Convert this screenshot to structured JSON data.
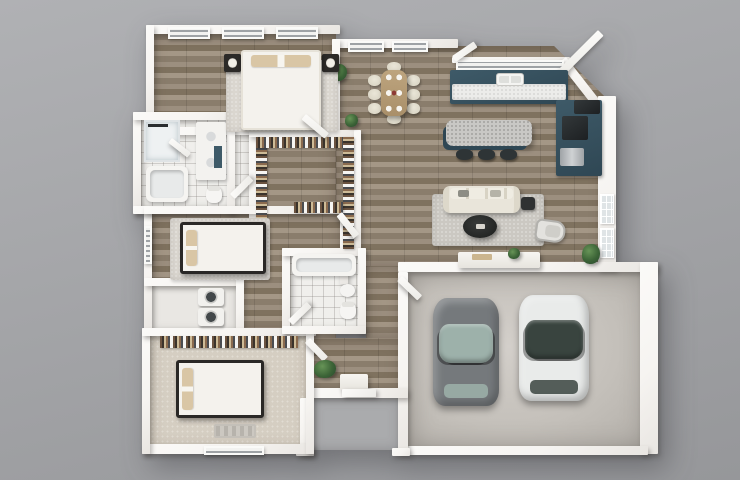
{
  "canvas": {
    "width": 740,
    "height": 480
  },
  "palette": {
    "bg1": "#b0b1b4",
    "bg2": "#96979a",
    "wall": "#f6f4f1",
    "wood1": "#9c8f7f",
    "wood2": "#8a7d6c",
    "wood3": "#a49786",
    "wood4": "#7f725f",
    "tile": "#f0efec",
    "carpet": "#d5cec2",
    "concrete1": "#d3cfca",
    "concrete2": "#b2aea8",
    "teal": "#3e5a68",
    "tealDark": "#2f4754",
    "counter": "#ececea",
    "cream": "#e9e5da",
    "tan": "#d9c6a5",
    "darkwood": "#2a2826",
    "rug": "#cbc8c2",
    "rugLight": "#dad6cf",
    "green1": "#679457",
    "green2": "#2f5130",
    "carGray": "#75797c",
    "carGrayGlass": "#9db1aa",
    "carWhite": "#e9ebea",
    "carWhiteGlass": "#39443f"
  },
  "scene": {
    "elements": [
      {
        "n": "floor-master-bedroom",
        "cls": "floor-wood",
        "x": 152,
        "y": 33,
        "w": 184,
        "h": 100
      },
      {
        "n": "floor-great-room",
        "cls": "floor-wood cut-tr",
        "x": 336,
        "y": 46,
        "w": 270,
        "h": 220
      },
      {
        "n": "floor-hallway",
        "cls": "floor-wood",
        "x": 233,
        "y": 133,
        "w": 103,
        "h": 205
      },
      {
        "n": "floor-hall-corridor",
        "cls": "floor-wood",
        "x": 366,
        "y": 266,
        "w": 36,
        "h": 72
      },
      {
        "n": "floor-entry",
        "cls": "floor-wood",
        "x": 310,
        "y": 338,
        "w": 92,
        "h": 56
      },
      {
        "n": "floor-master-bath",
        "cls": "floor-tile",
        "x": 141,
        "y": 118,
        "w": 108,
        "h": 90
      },
      {
        "n": "floor-bedroom2",
        "cls": "floor-wood",
        "x": 152,
        "y": 212,
        "w": 190,
        "h": 120
      },
      {
        "n": "floor-laundry-closet",
        "cls": "floor-plain",
        "x": 152,
        "y": 286,
        "w": 84,
        "h": 44
      },
      {
        "n": "floor-bath2",
        "cls": "floor-tile",
        "x": 290,
        "y": 252,
        "w": 72,
        "h": 78
      },
      {
        "n": "floor-bedroom3",
        "cls": "floor-carpet",
        "x": 150,
        "y": 334,
        "w": 158,
        "h": 114
      },
      {
        "n": "floor-garage",
        "cls": "floor-concrete",
        "x": 408,
        "y": 272,
        "w": 240,
        "h": 178
      },
      {
        "n": "floor-porch",
        "cls": "floor-porch",
        "x": 312,
        "y": 398,
        "w": 88,
        "h": 52
      },
      {
        "n": "wall-master-top",
        "cls": "wall",
        "x": 146,
        "y": 25,
        "w": 194,
        "h": 9
      },
      {
        "n": "wall-master-left",
        "cls": "wall",
        "x": 146,
        "y": 25,
        "w": 8,
        "h": 95
      },
      {
        "n": "wall-dining-top",
        "cls": "wall",
        "x": 332,
        "y": 39,
        "w": 126,
        "h": 9
      },
      {
        "n": "wall-kitchen-top",
        "cls": "wall",
        "x": 452,
        "y": 57,
        "w": 118,
        "h": 6
      },
      {
        "n": "wall-corner-diagonal",
        "cls": "wall",
        "x": 566,
        "y": 57,
        "w": 54,
        "h": 9,
        "rot": 52
      },
      {
        "n": "wall-right-living",
        "cls": "wall",
        "x": 598,
        "y": 96,
        "w": 18,
        "h": 174
      },
      {
        "n": "wall-garage-top",
        "cls": "wall",
        "x": 398,
        "y": 262,
        "w": 260,
        "h": 10
      },
      {
        "n": "wall-garage-right",
        "cls": "wall",
        "x": 640,
        "y": 262,
        "w": 18,
        "h": 192
      },
      {
        "n": "wall-garage-bottom",
        "cls": "wall",
        "x": 408,
        "y": 446,
        "w": 240,
        "h": 9
      },
      {
        "n": "wall-garage-left",
        "cls": "wall",
        "x": 398,
        "y": 272,
        "w": 10,
        "h": 182
      },
      {
        "n": "wall-entry-bottom",
        "cls": "wall",
        "x": 306,
        "y": 388,
        "w": 102,
        "h": 10
      },
      {
        "n": "wall-porch-left",
        "cls": "wall",
        "x": 300,
        "y": 398,
        "w": 10,
        "h": 56
      },
      {
        "n": "wall-porch-left-foot",
        "cls": "wall",
        "x": 296,
        "y": 448,
        "w": 18,
        "h": 8
      },
      {
        "n": "wall-porch-right-foot",
        "cls": "wall",
        "x": 392,
        "y": 448,
        "w": 18,
        "h": 8
      },
      {
        "n": "wall-bedroom3-bottom",
        "cls": "wall",
        "x": 142,
        "y": 444,
        "w": 172,
        "h": 10
      },
      {
        "n": "wall-bedroom3-left",
        "cls": "wall",
        "x": 142,
        "y": 328,
        "w": 8,
        "h": 126
      },
      {
        "n": "wall-bedroom2-left",
        "cls": "wall",
        "x": 144,
        "y": 206,
        "w": 8,
        "h": 126
      },
      {
        "n": "wall-masterbath-left",
        "cls": "wall",
        "x": 133,
        "y": 112,
        "w": 8,
        "h": 102
      },
      {
        "n": "wall-masterbath-top",
        "cls": "wall",
        "x": 133,
        "y": 112,
        "w": 120,
        "h": 8
      },
      {
        "n": "wall-masterbath-bottom",
        "cls": "wall",
        "x": 133,
        "y": 206,
        "w": 120,
        "h": 8
      },
      {
        "n": "wall-master-bottom",
        "cls": "wall",
        "x": 152,
        "y": 127,
        "w": 188,
        "h": 8
      },
      {
        "n": "wall-master-dining",
        "cls": "wall",
        "x": 332,
        "y": 39,
        "w": 8,
        "h": 96
      },
      {
        "n": "wall-bath-closet",
        "cls": "wall",
        "x": 227,
        "y": 112,
        "w": 8,
        "h": 102
      },
      {
        "n": "wall-closet-left",
        "cls": "wall",
        "x": 249,
        "y": 130,
        "w": 7,
        "h": 122
      },
      {
        "n": "wall-closet-top",
        "cls": "wall",
        "x": 249,
        "y": 130,
        "w": 112,
        "h": 7
      },
      {
        "n": "wall-closet-right",
        "cls": "wall",
        "x": 354,
        "y": 130,
        "w": 7,
        "h": 122
      },
      {
        "n": "wall-bedroom2-top",
        "cls": "wall",
        "x": 144,
        "y": 206,
        "w": 204,
        "h": 8
      },
      {
        "n": "wall-bedroom2-right",
        "cls": "wall",
        "x": 340,
        "y": 206,
        "w": 8,
        "h": 78
      },
      {
        "n": "wall-laundry-top",
        "cls": "wall",
        "x": 144,
        "y": 278,
        "w": 100,
        "h": 8
      },
      {
        "n": "wall-laundry-right",
        "cls": "wall",
        "x": 236,
        "y": 278,
        "w": 8,
        "h": 58
      },
      {
        "n": "wall-bedroom3-top",
        "cls": "wall",
        "x": 142,
        "y": 328,
        "w": 174,
        "h": 8
      },
      {
        "n": "wall-entry-left",
        "cls": "wall",
        "x": 306,
        "y": 328,
        "w": 8,
        "h": 126
      },
      {
        "n": "wall-bath2-left",
        "cls": "wall",
        "x": 282,
        "y": 248,
        "w": 8,
        "h": 86
      },
      {
        "n": "wall-bath2-top",
        "cls": "wall",
        "x": 282,
        "y": 248,
        "w": 84,
        "h": 8
      },
      {
        "n": "wall-bath2-right",
        "cls": "wall",
        "x": 358,
        "y": 248,
        "w": 8,
        "h": 86
      },
      {
        "n": "wall-bath2-bottom",
        "cls": "wall",
        "x": 282,
        "y": 326,
        "w": 84,
        "h": 8
      },
      {
        "n": "window-master-1",
        "cls": "win-louver",
        "x": 168,
        "y": 27,
        "w": 42,
        "h": 12
      },
      {
        "n": "window-master-2",
        "cls": "win-louver",
        "x": 222,
        "y": 27,
        "w": 42,
        "h": 12
      },
      {
        "n": "window-master-3",
        "cls": "win-louver",
        "x": 276,
        "y": 27,
        "w": 42,
        "h": 12
      },
      {
        "n": "window-dining-1",
        "cls": "win-louver",
        "x": 348,
        "y": 41,
        "w": 36,
        "h": 11
      },
      {
        "n": "window-dining-2",
        "cls": "win-louver",
        "x": 392,
        "y": 41,
        "w": 36,
        "h": 11
      },
      {
        "n": "window-kitchen",
        "cls": "win-louver",
        "x": 456,
        "y": 60,
        "w": 108,
        "h": 10
      },
      {
        "n": "window-bedroom2",
        "cls": "win-louver",
        "x": 144,
        "y": 226,
        "w": 8,
        "h": 38
      },
      {
        "n": "window-bedroom3",
        "cls": "win-louver",
        "x": 204,
        "y": 446,
        "w": 60,
        "h": 9
      },
      {
        "n": "window-living-1",
        "cls": "win-grid",
        "x": 600,
        "y": 194,
        "w": 14,
        "h": 30
      },
      {
        "n": "window-living-2",
        "cls": "win-grid",
        "x": 600,
        "y": 228,
        "w": 14,
        "h": 30
      },
      {
        "n": "open-window-pane",
        "cls": "door",
        "x": 452,
        "y": 56,
        "w": 26,
        "h": 7,
        "rot": -34
      },
      {
        "n": "patio-door-open",
        "cls": "door",
        "x": 598,
        "y": 30,
        "w": 8,
        "h": 56,
        "rot": 45
      },
      {
        "n": "kitchen-counter-teal",
        "cls": "cab-teal",
        "x": 450,
        "y": 70,
        "w": 118,
        "h": 34
      },
      {
        "n": "kitchen-counter-top",
        "cls": "counter-white",
        "x": 452,
        "y": 84,
        "w": 114,
        "h": 16
      },
      {
        "n": "kitchen-sink",
        "cls": "sink",
        "x": 496,
        "y": 73,
        "w": 28,
        "h": 13
      },
      {
        "n": "kitchen-cabinets-right",
        "cls": "cab-teal",
        "x": 556,
        "y": 100,
        "w": 46,
        "h": 76
      },
      {
        "n": "refrigerator",
        "cls": "appliance-dark",
        "x": 574,
        "y": 100,
        "w": 26,
        "h": 14
      },
      {
        "n": "stove-cooktop",
        "cls": "appliance-dark",
        "x": 562,
        "y": 116,
        "w": 26,
        "h": 24
      },
      {
        "n": "oven",
        "cls": "appliance-steel",
        "x": 560,
        "y": 148,
        "w": 24,
        "h": 18
      },
      {
        "n": "kitchen-island",
        "cls": "island-top",
        "x": 446,
        "y": 120,
        "w": 86,
        "h": 26
      },
      {
        "n": "island-stool-1",
        "cls": "stool",
        "x": 456,
        "y": 149,
        "w": 17,
        "h": 11
      },
      {
        "n": "island-stool-2",
        "cls": "stool",
        "x": 478,
        "y": 149,
        "w": 17,
        "h": 11
      },
      {
        "n": "island-stool-3",
        "cls": "stool",
        "x": 500,
        "y": 149,
        "w": 17,
        "h": 11
      },
      {
        "n": "dining-chair-head",
        "cls": "chair-cream",
        "x": 387,
        "y": 62,
        "w": 14,
        "h": 10
      },
      {
        "n": "dining-chair-foot",
        "cls": "chair-cream",
        "x": 387,
        "y": 114,
        "w": 14,
        "h": 10
      },
      {
        "n": "dining-chair-1",
        "cls": "chair-cream",
        "x": 368,
        "y": 75,
        "w": 13,
        "h": 11
      },
      {
        "n": "dining-chair-2",
        "cls": "chair-cream",
        "x": 368,
        "y": 89,
        "w": 13,
        "h": 11
      },
      {
        "n": "dining-chair-3",
        "cls": "chair-cream",
        "x": 368,
        "y": 103,
        "w": 13,
        "h": 11
      },
      {
        "n": "dining-chair-4",
        "cls": "chair-cream",
        "x": 407,
        "y": 75,
        "w": 13,
        "h": 11
      },
      {
        "n": "dining-chair-5",
        "cls": "chair-cream",
        "x": 407,
        "y": 89,
        "w": 13,
        "h": 11
      },
      {
        "n": "dining-chair-6",
        "cls": "chair-cream",
        "x": 407,
        "y": 103,
        "w": 13,
        "h": 11
      },
      {
        "n": "dining-table",
        "cls": "table-wood",
        "x": 381,
        "y": 70,
        "w": 26,
        "h": 46
      },
      {
        "n": "plant-dining-wall",
        "cls": "plant",
        "x": 330,
        "y": 64,
        "w": 17,
        "h": 17
      },
      {
        "n": "plant-hall-corner",
        "cls": "plant",
        "x": 345,
        "y": 114,
        "w": 13,
        "h": 13
      },
      {
        "n": "living-rug",
        "cls": "rug",
        "x": 432,
        "y": 194,
        "w": 112,
        "h": 52
      },
      {
        "n": "sofa",
        "cls": "sofa",
        "x": 443,
        "y": 186,
        "w": 77,
        "h": 27
      },
      {
        "n": "coffee-table",
        "cls": "coffee-table",
        "x": 463,
        "y": 215,
        "w": 34,
        "h": 23
      },
      {
        "n": "side-table",
        "cls": "side-table",
        "x": 521,
        "y": 197,
        "w": 14,
        "h": 13
      },
      {
        "n": "accent-chair",
        "cls": "accent-chair",
        "x": 537,
        "y": 218,
        "w": 30,
        "h": 22,
        "rot": 8
      },
      {
        "n": "media-console",
        "cls": "console",
        "x": 458,
        "y": 252,
        "w": 82,
        "h": 16
      },
      {
        "n": "console-decor",
        "cls": "deco-box",
        "x": 472,
        "y": 254,
        "w": 20,
        "h": 6
      },
      {
        "n": "plant-console",
        "cls": "plant",
        "x": 508,
        "y": 248,
        "w": 12,
        "h": 11
      },
      {
        "n": "plant-living-corner",
        "cls": "plant",
        "x": 582,
        "y": 244,
        "w": 18,
        "h": 20
      },
      {
        "n": "shower",
        "cls": "shower",
        "x": 144,
        "y": 120,
        "w": 36,
        "h": 42
      },
      {
        "n": "shower-door",
        "cls": "door",
        "x": 172,
        "y": 138,
        "w": 24,
        "h": 6,
        "rot": 38
      },
      {
        "n": "bath-vanity",
        "cls": "vanity",
        "x": 196,
        "y": 122,
        "w": 30,
        "h": 58
      },
      {
        "n": "vanity-accent",
        "cls": "teal-accent",
        "x": 214,
        "y": 146,
        "w": 8,
        "h": 22
      },
      {
        "n": "bathtub",
        "cls": "tub",
        "x": 146,
        "y": 166,
        "w": 42,
        "h": 36
      },
      {
        "n": "toilet",
        "cls": "toilet",
        "x": 206,
        "y": 186,
        "w": 16,
        "h": 17
      },
      {
        "n": "door-masterbath",
        "cls": "door",
        "x": 230,
        "y": 194,
        "w": 26,
        "h": 7,
        "rot": -45
      },
      {
        "n": "closet-rack-left",
        "cls": "rack-v",
        "x": 256,
        "y": 137,
        "w": 11,
        "h": 112
      },
      {
        "n": "closet-rack-top",
        "cls": "rack-h",
        "x": 256,
        "y": 137,
        "w": 96,
        "h": 11
      },
      {
        "n": "closet-rack-right",
        "cls": "rack-v",
        "x": 343,
        "y": 137,
        "w": 11,
        "h": 112
      },
      {
        "n": "closet-rack-mid",
        "cls": "rack-h",
        "x": 294,
        "y": 202,
        "w": 49,
        "h": 11
      },
      {
        "n": "master-rug",
        "cls": "rug light",
        "x": 226,
        "y": 60,
        "w": 112,
        "h": 72
      },
      {
        "n": "nightstand-left",
        "cls": "nightstand",
        "x": 224,
        "y": 54,
        "w": 17,
        "h": 18
      },
      {
        "n": "nightstand-right",
        "cls": "nightstand",
        "x": 322,
        "y": 54,
        "w": 17,
        "h": 18
      },
      {
        "n": "master-bed",
        "cls": "bed-v light",
        "x": 241,
        "y": 50,
        "w": 80,
        "h": 80
      },
      {
        "n": "door-master",
        "cls": "door",
        "x": 306,
        "y": 114,
        "w": 30,
        "h": 7,
        "rot": 40
      },
      {
        "n": "bedroom2-rug",
        "cls": "rug light",
        "x": 170,
        "y": 218,
        "w": 100,
        "h": 62
      },
      {
        "n": "bedroom2-bed",
        "cls": "bed-h dark",
        "x": 180,
        "y": 222,
        "w": 86,
        "h": 52
      },
      {
        "n": "door-bedroom2",
        "cls": "door",
        "x": 342,
        "y": 212,
        "w": 28,
        "h": 7,
        "rot": 52
      },
      {
        "n": "washer",
        "cls": "washer",
        "x": 198,
        "y": 288,
        "w": 26,
        "h": 18
      },
      {
        "n": "dryer",
        "cls": "washer",
        "x": 198,
        "y": 308,
        "w": 26,
        "h": 18
      },
      {
        "n": "bathtub2",
        "cls": "tub",
        "x": 292,
        "y": 254,
        "w": 64,
        "h": 22
      },
      {
        "n": "sink-pedestal",
        "cls": "sink-ped",
        "x": 340,
        "y": 284,
        "w": 15,
        "h": 13
      },
      {
        "n": "toilet2",
        "cls": "toilet",
        "x": 340,
        "y": 302,
        "w": 16,
        "h": 17
      },
      {
        "n": "door-bath2",
        "cls": "door",
        "x": 288,
        "y": 320,
        "w": 26,
        "h": 7,
        "rot": -44
      },
      {
        "n": "bedroom3-closet-rack",
        "cls": "rack-h",
        "x": 160,
        "y": 336,
        "w": 138,
        "h": 12
      },
      {
        "n": "bedroom3-bed",
        "cls": "bed-h dark",
        "x": 176,
        "y": 360,
        "w": 88,
        "h": 58
      },
      {
        "n": "bedroom3-mat",
        "cls": "mat",
        "x": 214,
        "y": 424,
        "w": 42,
        "h": 14
      },
      {
        "n": "door-bedroom3",
        "cls": "door",
        "x": 310,
        "y": 338,
        "w": 26,
        "h": 7,
        "rot": 46
      },
      {
        "n": "plant-entry",
        "cls": "plant",
        "x": 314,
        "y": 360,
        "w": 22,
        "h": 18
      },
      {
        "n": "entry-console",
        "cls": "console",
        "x": 340,
        "y": 374,
        "w": 28,
        "h": 16
      },
      {
        "n": "front-door",
        "cls": "door",
        "x": 342,
        "y": 389,
        "w": 34,
        "h": 8
      },
      {
        "n": "door-garage",
        "cls": "door",
        "x": 402,
        "y": 276,
        "w": 28,
        "h": 7,
        "rot": 44
      },
      {
        "n": "car-gray",
        "cls": "car",
        "x": 433,
        "y": 298,
        "w": 66,
        "h": 108,
        "c": "#75797c",
        "c2": "#9db1aa"
      },
      {
        "n": "car-white",
        "cls": "car",
        "x": 519,
        "y": 295,
        "w": 70,
        "h": 106,
        "c": "#e9ebea",
        "c2": "#39443f"
      }
    ]
  }
}
